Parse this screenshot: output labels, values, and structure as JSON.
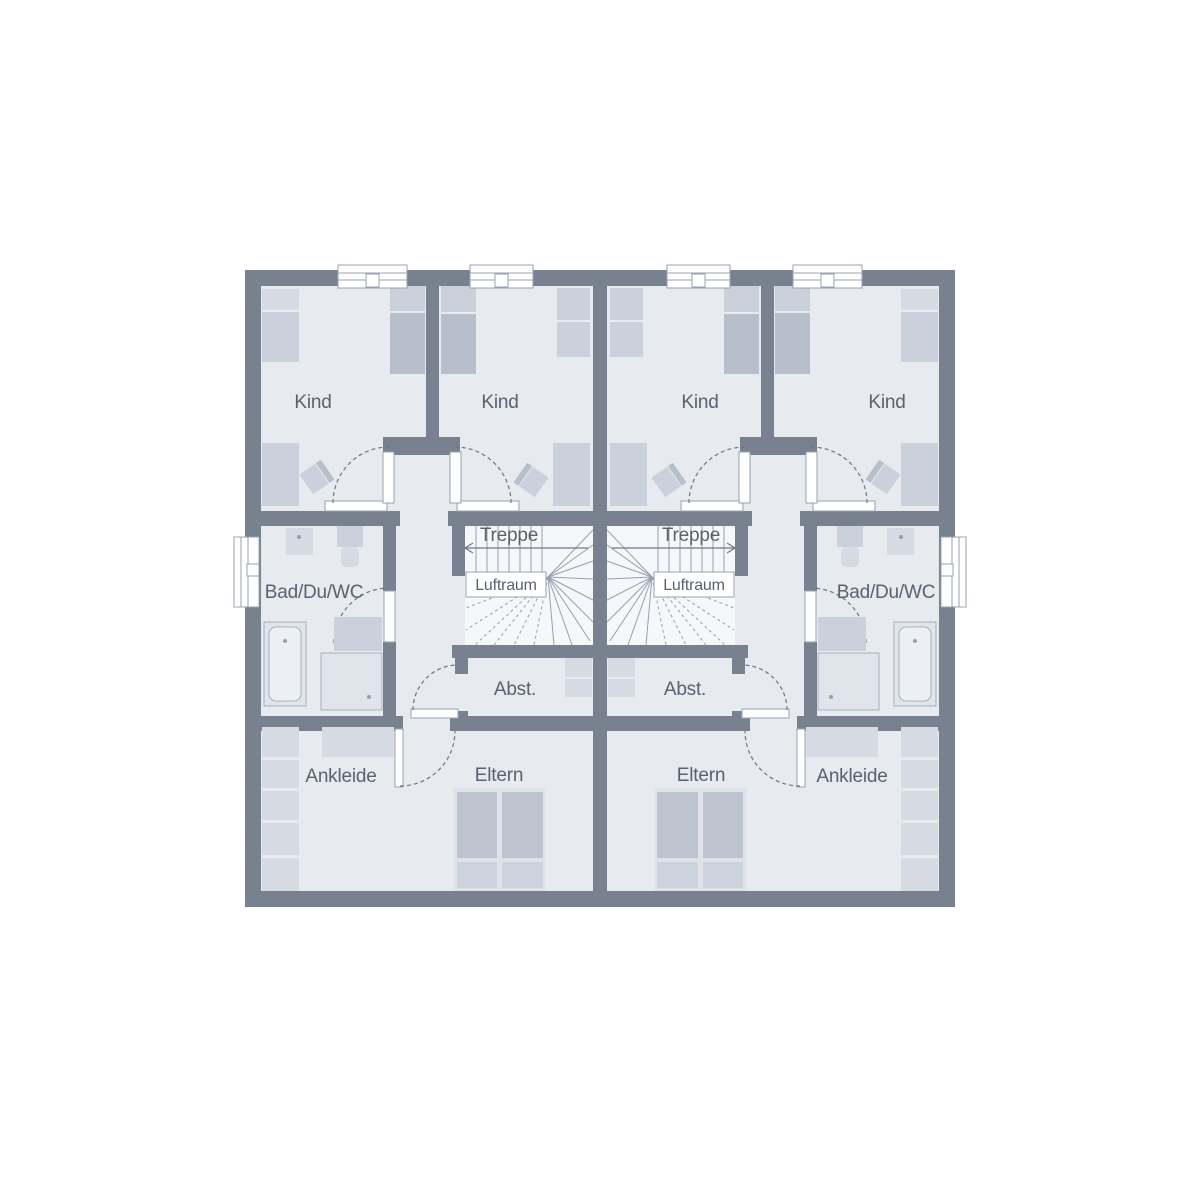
{
  "plan": {
    "type": "floor-plan",
    "description": "Upper floor plan of a mirrored semi-detached (duplex) house, two identical units",
    "room_labels": {
      "kind": "Kind",
      "treppe": "Treppe",
      "luftraum": "Luftraum",
      "bad": "Bad/Du/WC",
      "abstellraum": "Abst.",
      "ankleide": "Ankleide",
      "eltern": "Eltern"
    },
    "colors": {
      "wall": "#77818F",
      "floor": "#E7EAEF",
      "stairbg": "#F5F7FA",
      "fmid": "#CBD1DC",
      "flight": "#D6DBE3",
      "fxlight": "#E0E4EB",
      "ftub": "#ECEFF3",
      "kbed": "#B7BFCD",
      "kpillow": "#C9D0DA",
      "fmatt": "#BDC4D0",
      "bedframe": "#DFE3E9",
      "pillow": "#CDD3DC",
      "line": "#98A0AE",
      "linestrong": "#9AA2B0",
      "ink": "#6E7784",
      "text": "#5A6270"
    }
  }
}
